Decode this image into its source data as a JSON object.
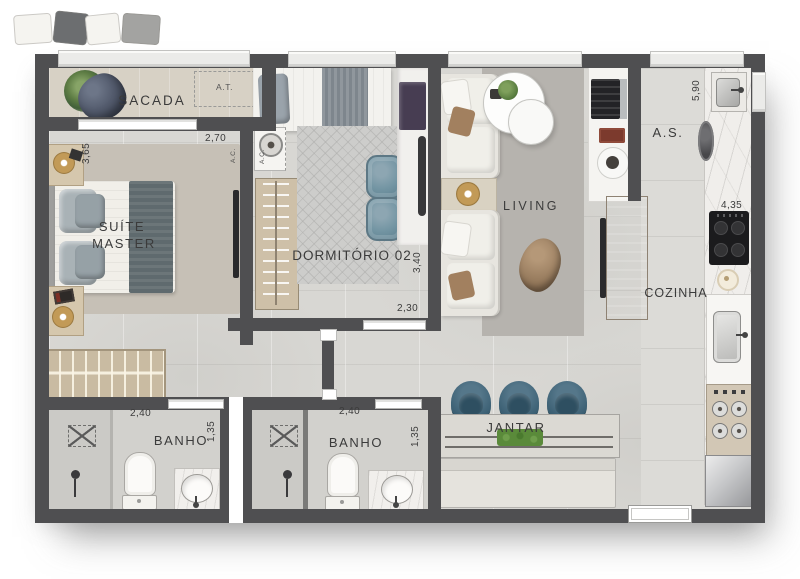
{
  "rooms": {
    "sacada": {
      "label": "SACADA"
    },
    "area_tecnica": {
      "label": "A.T."
    },
    "suite_master": {
      "label_line1": "SUÍTE",
      "label_line2": "MASTER",
      "dim_width": "2,70",
      "dim_depth": "3,65"
    },
    "ar_condicionado": {
      "label": "A.C."
    },
    "dormitorio_02": {
      "label": "DORMITÓRIO 02",
      "dim_depth": "3,40",
      "dim_door": "2,30"
    },
    "living": {
      "label": "LIVING"
    },
    "area_servico": {
      "label": "A.S.",
      "dim_depth": "5,90"
    },
    "cozinha": {
      "label": "COZINHA",
      "dim_width": "4,35"
    },
    "banho_1": {
      "label": "BANHO",
      "dim_width": "2,40",
      "dim_depth": "1,35"
    },
    "banho_2": {
      "label": "BANHO",
      "dim_width": "2,40",
      "dim_depth": "1,35"
    },
    "jantar": {
      "label": "JANTAR"
    }
  },
  "colors": {
    "wall": "#4f4f51",
    "floor": "#d8d7d3",
    "balcony_floor": "#d7d1c5",
    "chair_blue": "#3d6175",
    "wood": "#c9bba2",
    "plant_green": "#5a8a3a",
    "marble": "#f0eeeb"
  }
}
